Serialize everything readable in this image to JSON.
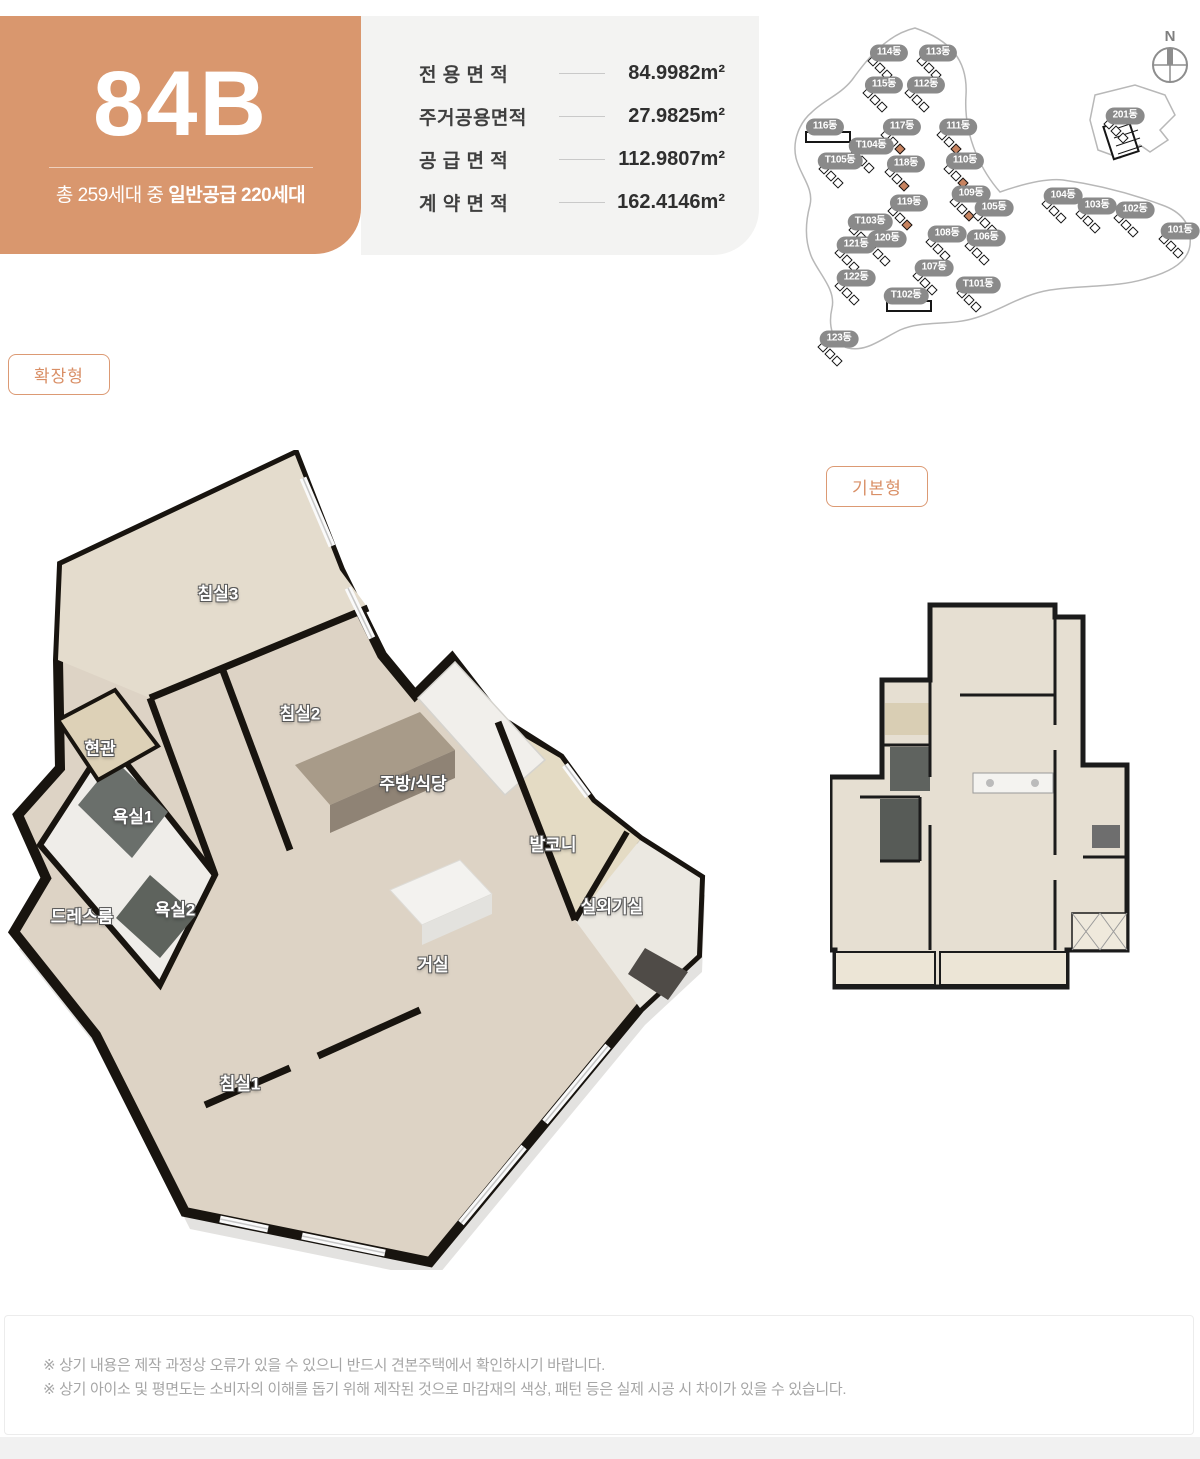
{
  "unit": {
    "code": "84B",
    "supply_prefix": "총 259세대 중",
    "supply_bold": "일반공급 220세대"
  },
  "area_table": {
    "rows": [
      {
        "label": "전 용 면 적",
        "value": "84.9982m²"
      },
      {
        "label": "주거공용면적",
        "value": "27.9825m²"
      },
      {
        "label": "공 급 면 적",
        "value": "112.9807m²"
      },
      {
        "label": "계 약 면 적",
        "value": "162.4146m²"
      }
    ]
  },
  "plan_badges": {
    "expanded": "확장형",
    "basic": "기본형"
  },
  "site_map": {
    "compass_label": "N",
    "buildings": [
      {
        "label": "114동",
        "x": 99,
        "y": 53,
        "hl": false
      },
      {
        "label": "113동",
        "x": 148,
        "y": 53,
        "hl": false
      },
      {
        "label": "115동",
        "x": 94,
        "y": 85,
        "hl": false
      },
      {
        "label": "112동",
        "x": 136,
        "y": 85,
        "hl": false
      },
      {
        "label": "116동",
        "x": 35,
        "y": 127,
        "hl": false,
        "wide": true
      },
      {
        "label": "117동",
        "x": 112,
        "y": 127,
        "hl": true
      },
      {
        "label": "111동",
        "x": 168,
        "y": 127,
        "hl": true
      },
      {
        "label": "T104동",
        "x": 81,
        "y": 146,
        "hl": false
      },
      {
        "label": "T105동",
        "x": 50,
        "y": 161,
        "hl": false
      },
      {
        "label": "118동",
        "x": 116,
        "y": 164,
        "hl": true
      },
      {
        "label": "110동",
        "x": 175,
        "y": 161,
        "hl": true
      },
      {
        "label": "201동",
        "x": 335,
        "y": 116,
        "hl": false
      },
      {
        "label": "109동",
        "x": 181,
        "y": 194,
        "hl": true
      },
      {
        "label": "119동",
        "x": 119,
        "y": 203,
        "hl": true
      },
      {
        "label": "105동",
        "x": 204,
        "y": 208,
        "hl": false
      },
      {
        "label": "104동",
        "x": 273,
        "y": 196,
        "hl": false
      },
      {
        "label": "103동",
        "x": 307,
        "y": 206,
        "hl": false
      },
      {
        "label": "102동",
        "x": 345,
        "y": 210,
        "hl": false
      },
      {
        "label": "101동",
        "x": 390,
        "y": 231,
        "hl": false
      },
      {
        "label": "T103동",
        "x": 80,
        "y": 222,
        "hl": false
      },
      {
        "label": "120동",
        "x": 97,
        "y": 239,
        "hl": false
      },
      {
        "label": "121동",
        "x": 66,
        "y": 245,
        "hl": false
      },
      {
        "label": "108동",
        "x": 157,
        "y": 234,
        "hl": false
      },
      {
        "label": "106동",
        "x": 196,
        "y": 238,
        "hl": false
      },
      {
        "label": "107동",
        "x": 144,
        "y": 268,
        "hl": false
      },
      {
        "label": "T101동",
        "x": 188,
        "y": 285,
        "hl": false
      },
      {
        "label": "122동",
        "x": 66,
        "y": 278,
        "hl": false
      },
      {
        "label": "T102동",
        "x": 116,
        "y": 296,
        "hl": false,
        "wide": true
      },
      {
        "label": "123동",
        "x": 49,
        "y": 339,
        "hl": false
      }
    ]
  },
  "floor_plan_rooms": [
    {
      "label": "침실3",
      "x": 218,
      "y": 142
    },
    {
      "label": "침실2",
      "x": 300,
      "y": 262
    },
    {
      "label": "현관",
      "x": 100,
      "y": 297
    },
    {
      "label": "욕실1",
      "x": 133,
      "y": 365
    },
    {
      "label": "주방/식당",
      "x": 413,
      "y": 332
    },
    {
      "label": "발코니",
      "x": 553,
      "y": 393
    },
    {
      "label": "드레스룸",
      "x": 82,
      "y": 465
    },
    {
      "label": "욕실2",
      "x": 175,
      "y": 458
    },
    {
      "label": "실외기실",
      "x": 612,
      "y": 455
    },
    {
      "label": "거실",
      "x": 433,
      "y": 513
    },
    {
      "label": "침실1",
      "x": 240,
      "y": 632
    }
  ],
  "disclaimer": {
    "lines": [
      "※ 상기 내용은 제작 과정상 오류가 있을 수 있으니 반드시 견본주택에서 확인하시기 바랍니다.",
      "※ 상기 아이소 및 평면도는 소비자의 이해를 돕기 위해 제작된 것으로 마감재의 색상, 패턴 등은 실제 시공 시 차이가 있을 수 있습니다."
    ]
  },
  "colors": {
    "accent_orange": "#d9976e",
    "badge_gray": "#8a8a8a",
    "unit_highlight": "#c8835f",
    "info_bg": "#f3f3f2"
  }
}
